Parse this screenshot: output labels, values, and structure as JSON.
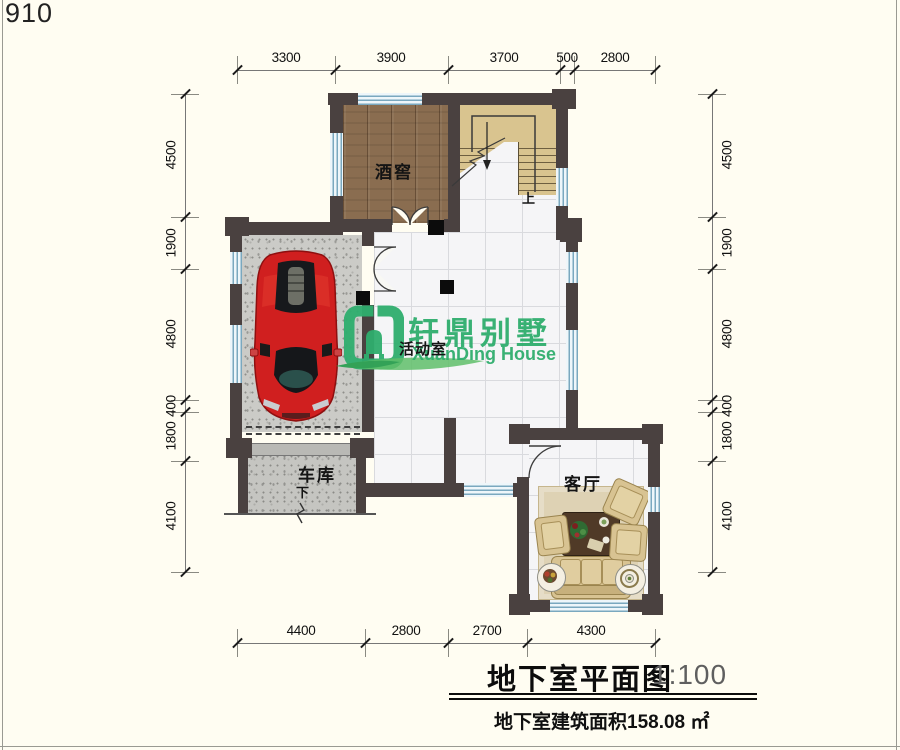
{
  "page": {
    "number": "910"
  },
  "dimensions": {
    "top": [
      "3300",
      "3900",
      "3700",
      "500",
      "2800"
    ],
    "bottom": [
      "4400",
      "2800",
      "2700",
      "4300"
    ],
    "left": [
      "4500",
      "1900",
      "4800",
      "400",
      "1800",
      "4100"
    ],
    "right": [
      "4500",
      "1900",
      "4800",
      "400",
      "1800",
      "4100"
    ]
  },
  "rooms": {
    "wine_cellar": "酒窖",
    "activity_room": "活动室",
    "garage": "车库",
    "living_room": "客厅"
  },
  "stairs": {
    "up_label": "上"
  },
  "ramp": {
    "down_label": "下"
  },
  "watermark": {
    "brand_cn": "轩鼎别墅",
    "brand_en": "XuanDing House",
    "logo_icon": "green-house-logo",
    "color": "#2fae6e"
  },
  "illustrations": {
    "car": "red-sports-car-top-view"
  },
  "title_block": {
    "title": "地下室平面图",
    "scale": "1:100",
    "subtitle": "地下室建筑面积158.08 ㎡"
  },
  "colors": {
    "background": "#fffdf2",
    "wall": "#4a4140",
    "window_blue": "#7aa8bf",
    "wood_floor": "#8a6d50",
    "stair_tan": "#d9c48f",
    "concrete": "#cbcbc7",
    "tile": "#f5f5f7",
    "rug": "#ded2b4",
    "sofa": "#d8c392",
    "coffee_table": "#503a27",
    "car_red": "#d01f1f",
    "accent_green": "#2fae6e"
  }
}
